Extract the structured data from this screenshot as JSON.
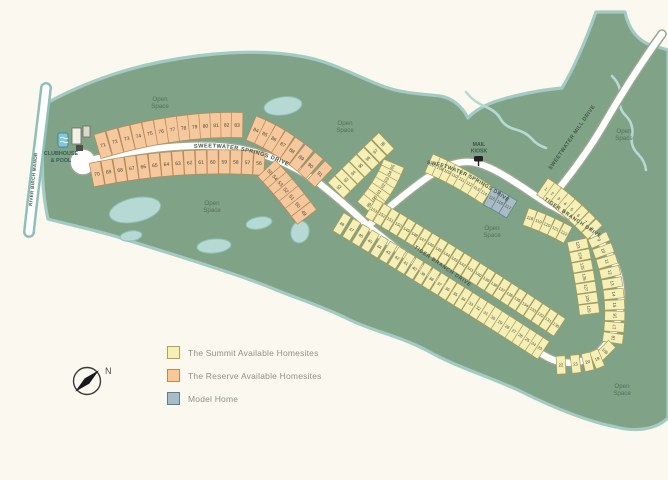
{
  "legend": {
    "items": [
      {
        "label": "The Summit Available Homesites",
        "color": "#f6f0b8",
        "border": "#b0a24e"
      },
      {
        "label": "The Reserve Available Homesites",
        "color": "#f6c89d",
        "border": "#c08a4a"
      },
      {
        "label": "Model Home",
        "color": "#a9bcc6",
        "border": "#5f7d8c"
      }
    ]
  },
  "compass": {
    "label": "N"
  },
  "poi": {
    "clubhouse_label_lines": [
      "CLUBHOUSE",
      "& POOL"
    ],
    "mail_kiosk_label_lines": [
      "MAIL",
      "KIOSK"
    ]
  },
  "map": {
    "colors": {
      "background": "#fbf9ef",
      "green": "#80a287",
      "coast": "#a3cbc4",
      "pond_fill": "#b7d9d4",
      "pond_stroke": "#8fbfb7",
      "road_fill": "#ffffff",
      "road_casing": "#9aa88e",
      "summit": {
        "fill": "#f6f0b8",
        "stroke": "#a89c55"
      },
      "reserve": {
        "fill": "#f6c89d",
        "stroke": "#b98a54"
      },
      "model": {
        "fill": "#a9bcc6",
        "stroke": "#5f7d8c"
      },
      "lot_text": "#4a4a38",
      "map_text": "#54705f",
      "road_text": "#44584a"
    },
    "open_space_label": "Open Space",
    "open_space_positions": [
      [
        160,
        101
      ],
      [
        345,
        125
      ],
      [
        212,
        205
      ],
      [
        492,
        230
      ],
      [
        624,
        133
      ],
      [
        622,
        388
      ]
    ],
    "road_labels": [
      {
        "text": "SWEETWATER SPRINGS DRIVE",
        "path": "M 194,148 Q 246,144 296,170",
        "size": 5.6,
        "ls": 0.5
      },
      {
        "text": "SWEETWATER SPRINGS DRIVE",
        "path": "M 427,164 Q 464,168 523,213",
        "size": 5.3,
        "ls": 0.4
      },
      {
        "text": "SWEETWATER MILL DRIVE",
        "path": "M 551,170 L 608,88",
        "size": 5.3,
        "ls": 0.4
      },
      {
        "text": "TIGER BRANCH DRIVE",
        "path": "M 414,248 L 486,298",
        "size": 5.2,
        "ls": 0.6
      },
      {
        "text": "TIGER BRANCH DRIVE",
        "path": "M 544,200 L 603,240",
        "size": 5.2,
        "ls": 0.6
      },
      {
        "text": "RIVER BIRCH MANOR",
        "path": "M 32,206 L 42,110",
        "size": 4.6,
        "ls": 0.3
      }
    ],
    "strips": [
      {
        "type": "reserve",
        "numbers": [
          71,
          72,
          73,
          74,
          75,
          76,
          77,
          78,
          79,
          80,
          81,
          82,
          83
        ],
        "start": [
          103,
          145
        ],
        "control": [
          175,
          124
        ],
        "end": [
          237,
          125
        ],
        "w": 11.5,
        "d": 25,
        "fs": 5
      },
      {
        "type": "reserve",
        "numbers": [
          84,
          85,
          86,
          87,
          88,
          89,
          90,
          91
        ],
        "start": [
          256,
          130
        ],
        "control": [
          287,
          143
        ],
        "end": [
          320,
          174
        ],
        "w": 10.5,
        "d": 26,
        "fs": 5
      },
      {
        "type": "reserve",
        "numbers": [
          70,
          69,
          68,
          67,
          66,
          65,
          64,
          63,
          62,
          61,
          60,
          59,
          58,
          57,
          56
        ],
        "start": [
          97,
          174
        ],
        "control": [
          178,
          158
        ],
        "end": [
          259,
          163
        ],
        "w": 11,
        "d": 24,
        "fs": 5
      },
      {
        "type": "reserve",
        "numbers": [
          55,
          54,
          53,
          52,
          51,
          50,
          49
        ],
        "start": [
          270,
          172
        ],
        "control": [
          285,
          188
        ],
        "end": [
          304,
          213
        ],
        "w": 10,
        "d": 24,
        "fs": 5
      },
      {
        "type": "summit",
        "numbers": [
          92,
          93,
          94,
          95,
          96,
          97,
          98
        ],
        "start": [
          339,
          187
        ],
        "control": [
          360,
          166
        ],
        "end": [
          383,
          144
        ],
        "w": 9.5,
        "d": 22,
        "fs": 4.4
      },
      {
        "type": "summit",
        "numbers": [
          105,
          104,
          103,
          102,
          101,
          100,
          99
        ],
        "start": [
          392,
          168
        ],
        "control": [
          384,
          187
        ],
        "end": [
          369,
          205
        ],
        "w": 10,
        "d": 22,
        "fs": 4.4
      },
      {
        "type": "summit",
        "numbers": [
          107,
          108,
          109,
          110,
          111,
          112,
          113,
          114
        ],
        "start": [
          433,
          165
        ],
        "control": [
          458,
          176
        ],
        "end": [
          484,
          193
        ],
        "w": 9,
        "d": 20,
        "fs": 4.2
      },
      {
        "type": "model",
        "numbers": [
          115,
          116,
          117
        ],
        "start": [
          492,
          198
        ],
        "control": [
          500,
          202
        ],
        "end": [
          508,
          207
        ],
        "w": 9,
        "d": 20,
        "fs": 4.2
      },
      {
        "type": "summit",
        "numbers": [
          118,
          119,
          120,
          121,
          122
        ],
        "start": [
          530,
          218
        ],
        "control": [
          547,
          224
        ],
        "end": [
          564,
          233
        ],
        "w": 9,
        "d": 18,
        "fs": 4.2
      },
      {
        "type": "summit",
        "numbers": [
          123,
          124,
          125,
          126,
          127,
          128,
          129
        ],
        "start": [
          578,
          245
        ],
        "control": [
          585,
          277
        ],
        "end": [
          589,
          309
        ],
        "w": 10,
        "d": 20,
        "fs": 4.2
      },
      {
        "type": "summit",
        "numbers": [
          1,
          2,
          3,
          4,
          5,
          6,
          7,
          8
        ],
        "start": [
          546,
          189
        ],
        "control": [
          568,
          204
        ],
        "end": [
          592,
          229
        ],
        "w": 9,
        "d": 20,
        "fs": 4.4
      },
      {
        "type": "summit",
        "numbers": [
          9,
          10,
          11,
          12,
          13,
          14,
          15,
          16,
          17,
          18
        ],
        "start": [
          599,
          240
        ],
        "control": [
          620,
          288
        ],
        "end": [
          613,
          338
        ],
        "w": 9.5,
        "d": 20,
        "fs": 4.4
      },
      {
        "type": "summit",
        "numbers": [
          106
        ],
        "start": [
          602,
          348
        ],
        "control": null,
        "end": [
          608,
          354
        ],
        "w": 10,
        "d": 20,
        "fs": 4.2
      },
      {
        "type": "summit",
        "numbers": [
          19,
          20,
          21,
          22
        ],
        "start": [
          597,
          359
        ],
        "control": [
          585,
          364
        ],
        "end": [
          561,
          365
        ],
        "w": 9,
        "d": 18,
        "fs": 4.4
      },
      {
        "type": "summit",
        "numbers": [
          23,
          24,
          25,
          26,
          27,
          28,
          29,
          30,
          31,
          32,
          33,
          34,
          35,
          36,
          37,
          38,
          39,
          40,
          41,
          42,
          43,
          44,
          45,
          46,
          47,
          48
        ],
        "start": [
          540,
          348
        ],
        "control": [
          462,
          297
        ],
        "end": [
          342,
          224
        ],
        "w": 8.6,
        "d": 21,
        "fs": 4.2
      },
      {
        "type": "summit",
        "numbers": [
          130,
          131,
          132,
          133,
          134,
          135,
          136,
          137,
          138,
          139,
          140,
          141,
          142,
          143,
          144,
          145,
          146,
          147,
          148,
          149,
          150,
          151,
          152,
          153
        ],
        "start": [
          556,
          325
        ],
        "control": [
          468,
          266
        ],
        "end": [
          374,
          210
        ],
        "w": 8.6,
        "d": 21,
        "fs": 4.2
      }
    ]
  }
}
